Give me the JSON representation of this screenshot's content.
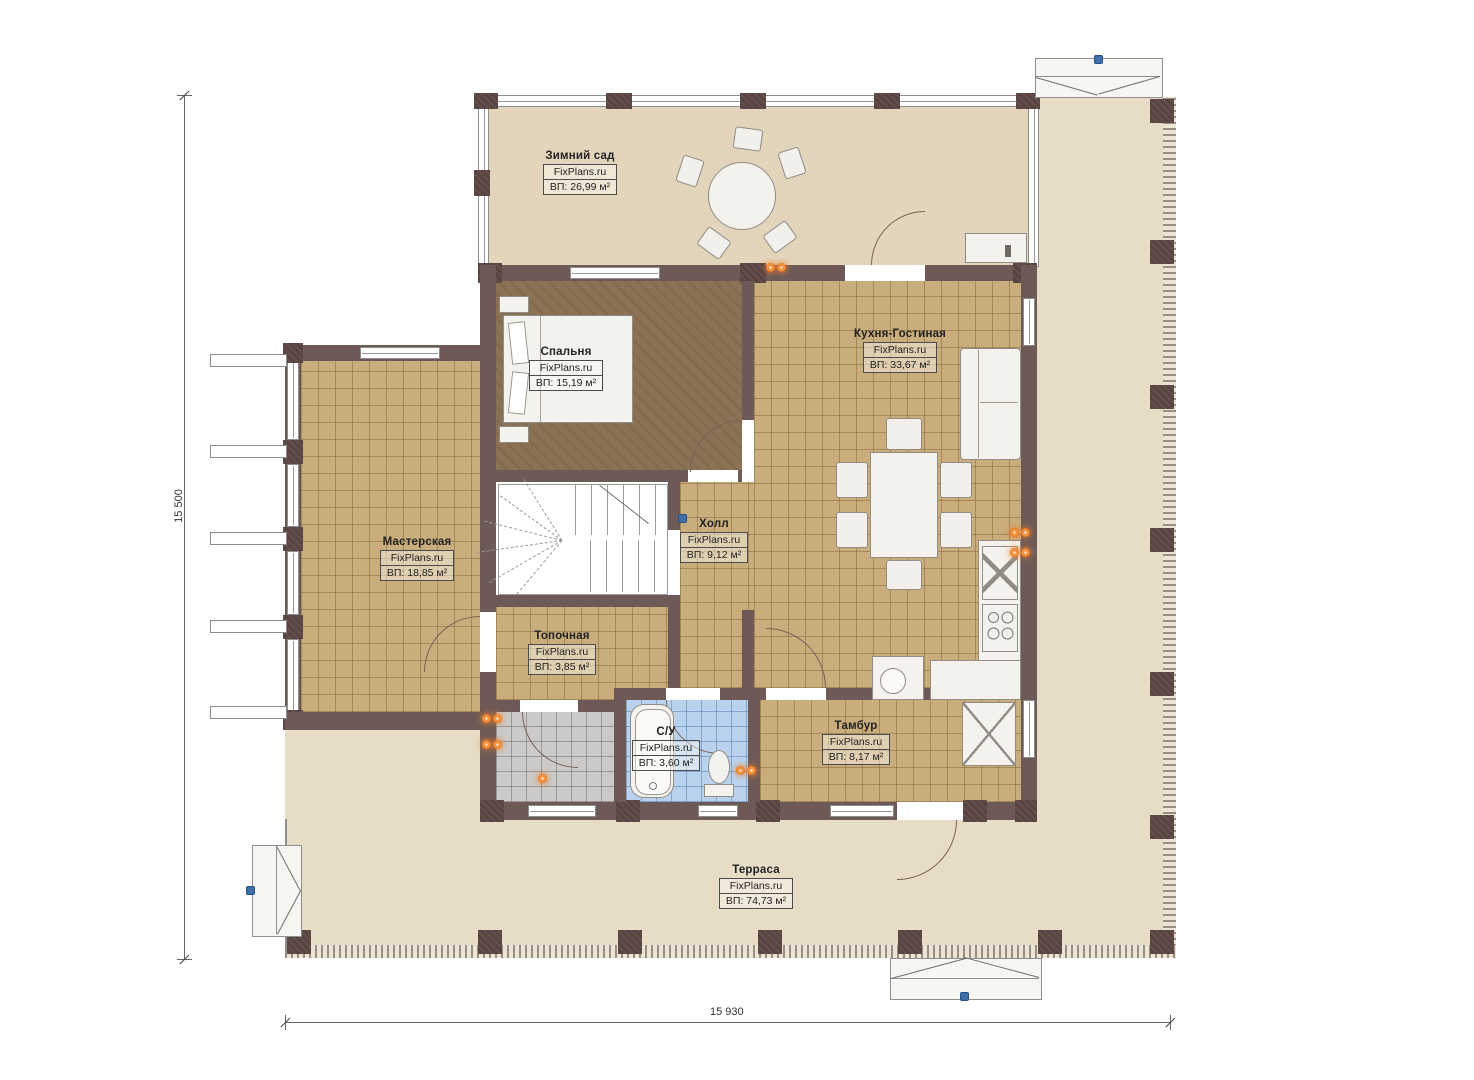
{
  "brand": "FixPlans.ru",
  "dimensions": {
    "left_label": "15 500",
    "bottom_label": "15 930"
  },
  "rooms": [
    {
      "name": "Зимний сад",
      "brand": "FixPlans.ru",
      "area": "ВП: 26,99 м²"
    },
    {
      "name": "Спальня",
      "brand": "FixPlans.ru",
      "area": "ВП: 15,19 м²"
    },
    {
      "name": "Кухня-Гостиная",
      "brand": "FixPlans.ru",
      "area": "ВП: 33,67 м²"
    },
    {
      "name": "Мастерская",
      "brand": "FixPlans.ru",
      "area": "ВП: 18,85 м²"
    },
    {
      "name": "Холл",
      "brand": "FixPlans.ru",
      "area": "ВП: 9,12 м²"
    },
    {
      "name": "Топочная",
      "brand": "FixPlans.ru",
      "area": "ВП: 3,85 м²"
    },
    {
      "name": "С/У",
      "brand": "FixPlans.ru",
      "area": "ВП: 3,60 м²"
    },
    {
      "name": "Тамбур",
      "brand": "FixPlans.ru",
      "area": "ВП: 8,17 м²"
    },
    {
      "name": "Терраса",
      "brand": "FixPlans.ru",
      "area": "ВП: 74,73 м²"
    }
  ],
  "colors": {
    "wall": "#6d5a57",
    "floor_tan": "#c9ad7c",
    "floor_beige": "#e7dcc6",
    "floor_bedroom": "#8b7254",
    "floor_bath": "#b9d3ee",
    "outlet_orange": "#f07c2a",
    "marker_blue": "#3f6ea8"
  }
}
